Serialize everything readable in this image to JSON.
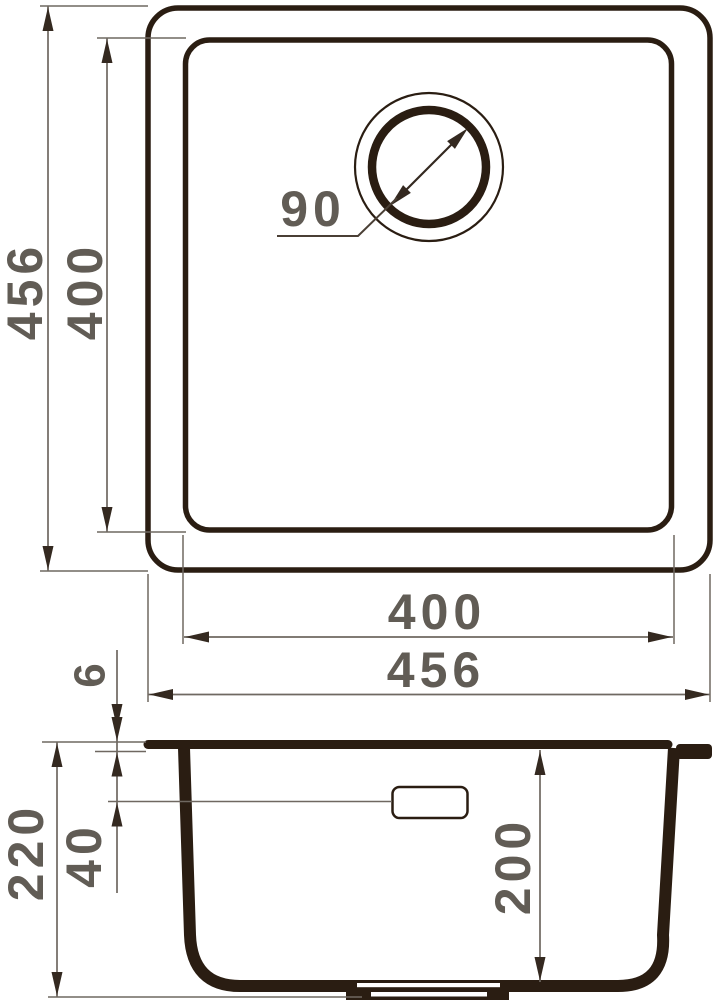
{
  "colors": {
    "outline": "#2a1d12",
    "dimension_line": "#6f6861",
    "arrowhead": "#342920",
    "label_text": "#615c55",
    "background": "#ffffff"
  },
  "plan_view": {
    "outer_size_vertical": "456",
    "inner_size_vertical": "400",
    "drain_diameter": "90",
    "inner_size_horizontal": "400",
    "outer_size_horizontal": "456"
  },
  "section_view": {
    "rim_thickness": "6",
    "total_depth": "220",
    "overflow_offset": "40",
    "bowl_depth": "200"
  }
}
